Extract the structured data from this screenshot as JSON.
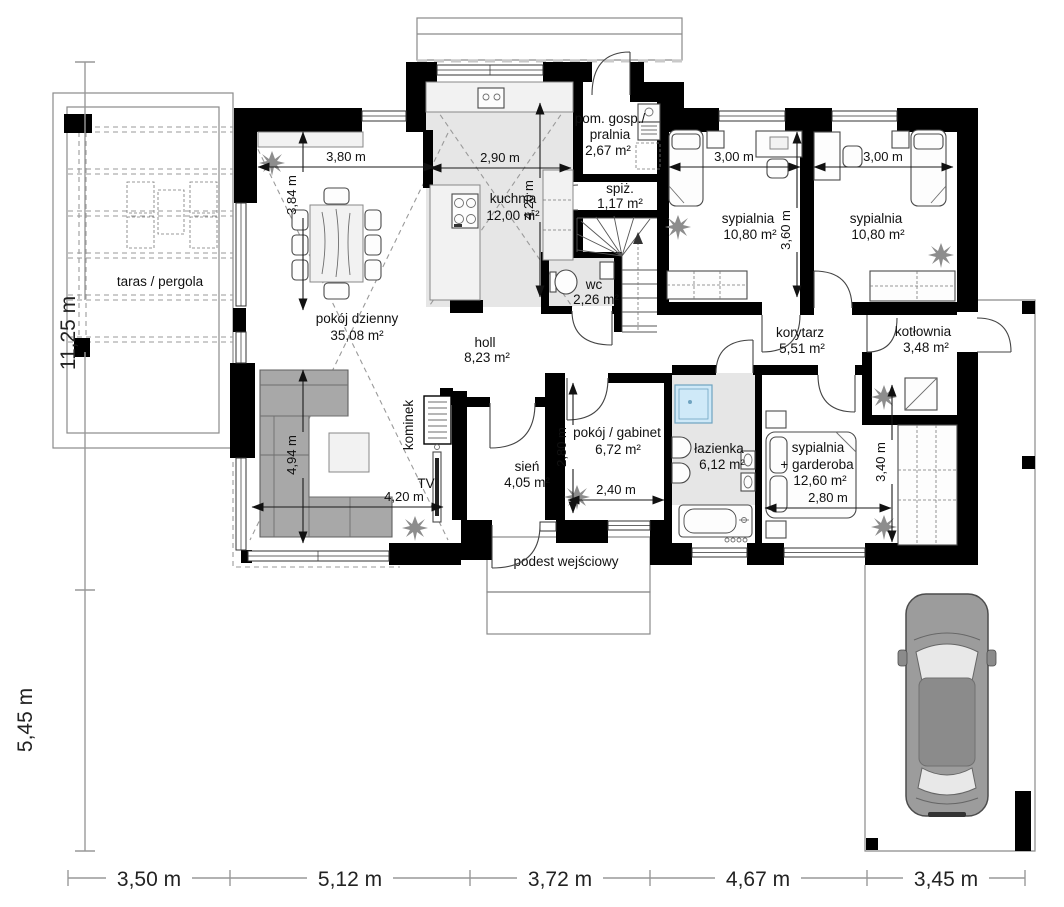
{
  "rooms": {
    "taras": {
      "label": "taras / pergola"
    },
    "pokoj_dzienny": {
      "label": "pokój dzienny",
      "area": "35,08 m²"
    },
    "kuchnia": {
      "label": "kuchnia",
      "area": "12,00 m²"
    },
    "pom_gosp": {
      "label1": "pom. gosp./",
      "label2": "pralnia",
      "area": "2,67 m²"
    },
    "spiz": {
      "label": "spiż.",
      "area": "1,17 m²"
    },
    "wc": {
      "label": "wc",
      "area": "2,26 m²"
    },
    "sypialnia1": {
      "label": "sypialnia",
      "area": "10,80 m²"
    },
    "sypialnia2": {
      "label": "sypialnia",
      "area": "10,80 m²"
    },
    "korytarz": {
      "label": "korytarz",
      "area": "5,51 m²"
    },
    "kotlownia": {
      "label": "kotłownia",
      "area": "3,48 m²"
    },
    "holl": {
      "label": "holl",
      "area": "8,23 m²"
    },
    "sien": {
      "label": "sień",
      "area": "4,05 m²"
    },
    "gabinet": {
      "label": "pokój / gabinet",
      "area": "6,72 m²"
    },
    "lazienka": {
      "label": "łazienka",
      "area": "6,12 m²"
    },
    "syp_garderoba": {
      "label1": "sypialnia",
      "label2": "+ garderoba",
      "area": "12,60 m²"
    },
    "podest": {
      "label": "podest wejściowy"
    }
  },
  "annotations": {
    "kominek": "kominek",
    "tv": "TV"
  },
  "dims": {
    "interior": {
      "living_top": "3,80 m",
      "living_left_upper": "3,84 m",
      "living_left_lower": "4,94 m",
      "living_bottom": "4,20 m",
      "kitchen_w": "2,90 m",
      "kitchen_h": "4,20 m",
      "bedroom1_w": "3,00 m",
      "bedroom2_w": "3,00 m",
      "bedrooms_h": "3,60 m",
      "gabinet_h": "2,80 m",
      "gabinet_w": "2,40 m",
      "master_w": "2,80 m",
      "master_h": "3,40 m"
    },
    "left": {
      "upper": "11,25 m",
      "lower": "5,45 m"
    },
    "bottom": [
      "3,50 m",
      "5,12 m",
      "3,72 m",
      "4,67 m",
      "3,45 m"
    ]
  },
  "colors": {
    "wall": "#000000",
    "floor_tint": "#e6e6e6",
    "shower": "#cfe9f8",
    "sofa": "#a8a8a8",
    "car": "#9c9c9c"
  }
}
